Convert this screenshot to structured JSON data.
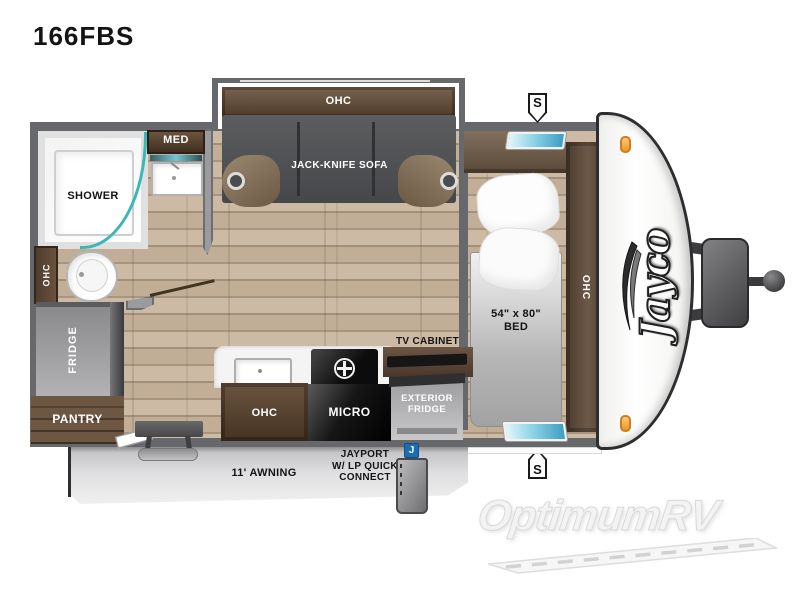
{
  "page": {
    "title": "166FBS"
  },
  "plan": {
    "slideout": {
      "ohc": "OHC",
      "sofa": "JACK-KNIFE SOFA"
    },
    "bath": {
      "med": "MED",
      "shower": "SHOWER",
      "ohc": "OHC"
    },
    "storage": {
      "fridge": "FRIDGE",
      "pantry": "PANTRY"
    },
    "kitchen": {
      "ohc": "OHC",
      "micro": "MICRO"
    },
    "media": {
      "tv_cabinet": "TV CABINET",
      "ext_fridge_1": "EXTERIOR",
      "ext_fridge_2": "FRIDGE"
    },
    "bedroom": {
      "bed_size": "54\" x 80\"",
      "bed": "BED",
      "ohc": "OHC"
    },
    "exterior": {
      "awning": "11' AWNING",
      "jayport_1": "JAYPORT",
      "jayport_2": "W/ LP QUICK",
      "jayport_3": "CONNECT",
      "jayport_badge": "J",
      "speaker": "S"
    },
    "brand": {
      "logo": "Jayco"
    }
  },
  "watermark": {
    "brand": "OptimumRV"
  },
  "colors": {
    "wall": "#67686b",
    "wood_floor": "#c2ae97",
    "cabinet_brown": "#5d4a38",
    "accent_teal": "#3ab7b7",
    "jayport_blue": "#1c6cb4",
    "marker_light_orange": "#f0a030",
    "appliance_black": "#111111",
    "awning_gray": "#d6d6d8"
  }
}
